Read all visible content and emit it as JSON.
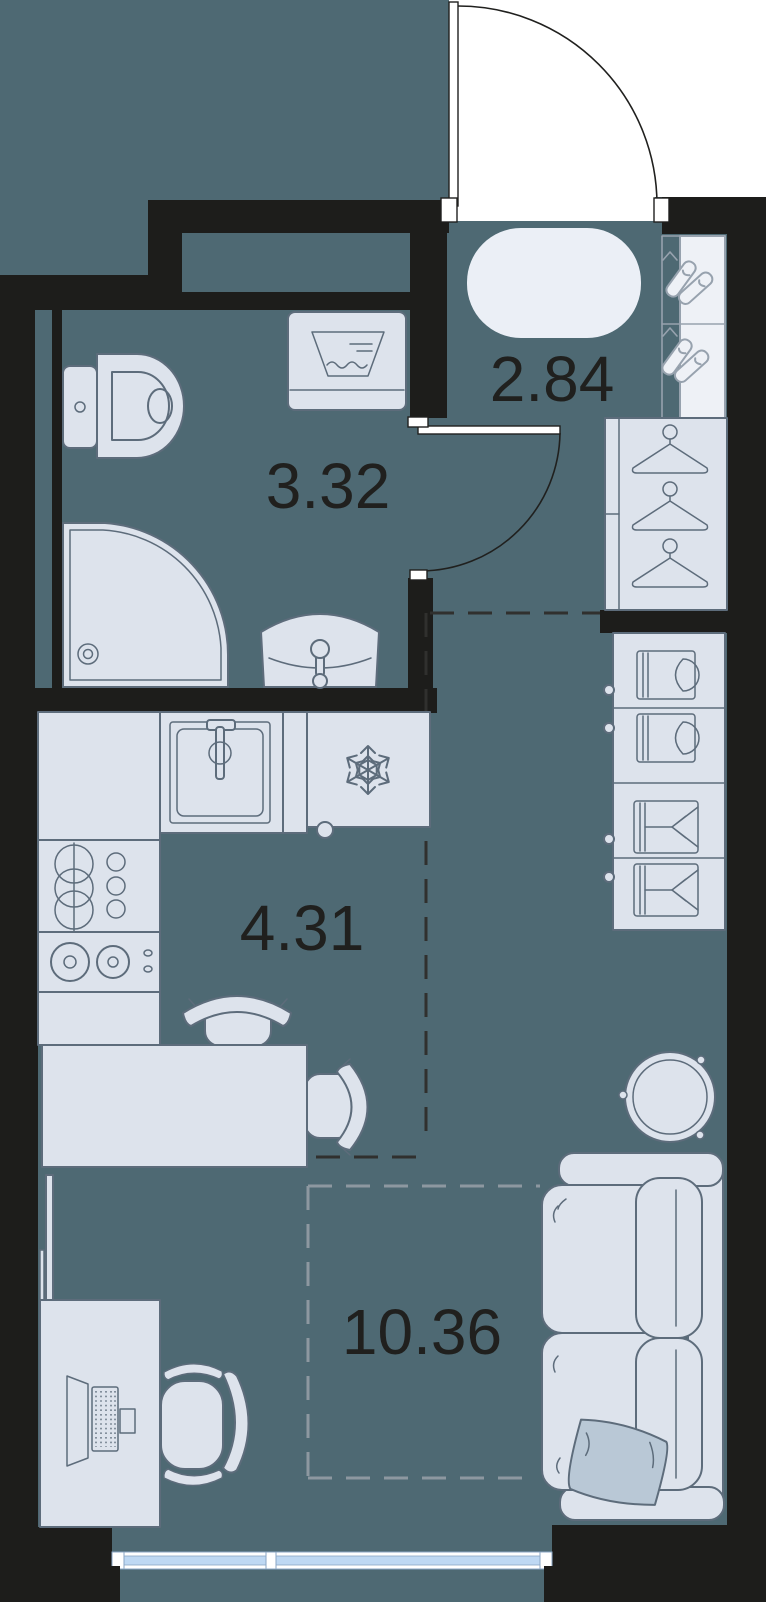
{
  "plan": {
    "title": "Studio apartment floor plan",
    "rooms": [
      {
        "id": "hallway",
        "area_label": "2.84"
      },
      {
        "id": "bathroom",
        "area_label": "3.32"
      },
      {
        "id": "kitchen",
        "area_label": "4.31"
      },
      {
        "id": "living-room",
        "area_label": "10.36"
      }
    ],
    "furniture_icons": [
      "entry-door",
      "bathroom-door",
      "oval-rug",
      "shoe-rack",
      "wardrobe-hangers",
      "folded-clothes-shelf",
      "toilet",
      "washing-machine",
      "shower-cabin",
      "bathroom-sink",
      "kitchen-sink",
      "fridge-snowflake",
      "dish-rack",
      "stove-burners",
      "dining-table",
      "chair",
      "round-table",
      "sofa",
      "pillow",
      "desk",
      "laptop",
      "office-chair",
      "tv-panel",
      "window"
    ],
    "colors": {
      "floor": "#4e6973",
      "wall": "#1d1d1b",
      "furn-fill": "#dde3ec",
      "furn-stroke": "#5d6c7b",
      "outline-dark": "#20201e",
      "pillow": "#b9c8d6",
      "window-blue": "#bed8f3",
      "window-frame": "#8aa6c4",
      "rug": "#ebeff6",
      "dash-dark": "#30302e",
      "dash-light": "#8d98a0",
      "shoe-stroke": "#97a2ae",
      "label": "#20201e"
    }
  }
}
